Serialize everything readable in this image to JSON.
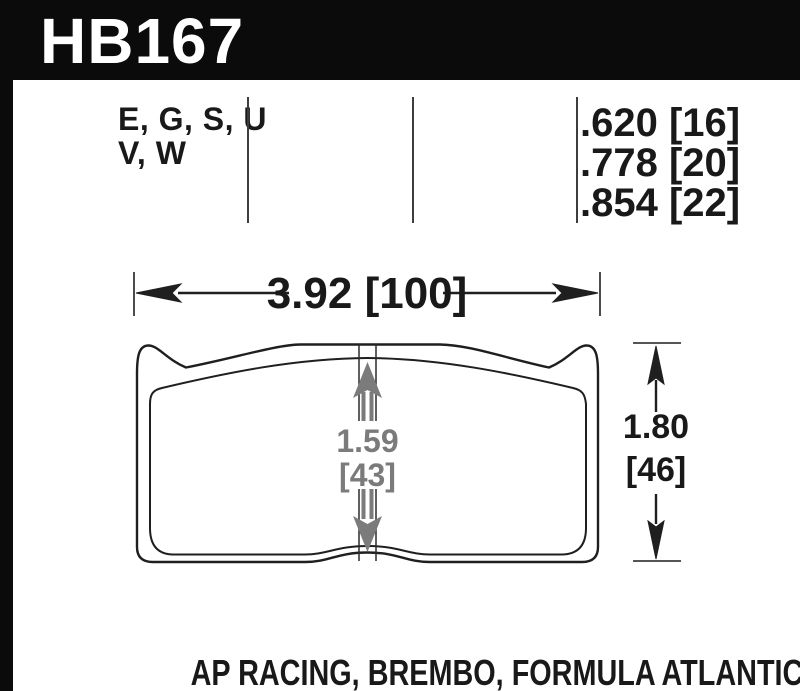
{
  "header": {
    "part_number": "HB167"
  },
  "spec_row": {
    "compounds": {
      "line1": "E, G, S, U",
      "line2": "V, W"
    },
    "thicknesses": [
      ".620 [16]",
      ".778 [20]",
      ".854 [22]"
    ]
  },
  "dimensions": {
    "pad_width": "3.92 [100]",
    "center_height": {
      "value": "1.59",
      "metric": "[43]"
    },
    "overall_height": {
      "value": "1.80",
      "metric": "[46]"
    }
  },
  "caption": "AP RACING, BREMBO, FORMULA ATLANTIC",
  "colors": {
    "banner_bg": "#0b0b0b",
    "paper": "#ffffff",
    "line": "#1f1f1f",
    "divider": "#3d3d3d",
    "dim_gray": "#7b7b7b",
    "text": "#191919"
  }
}
